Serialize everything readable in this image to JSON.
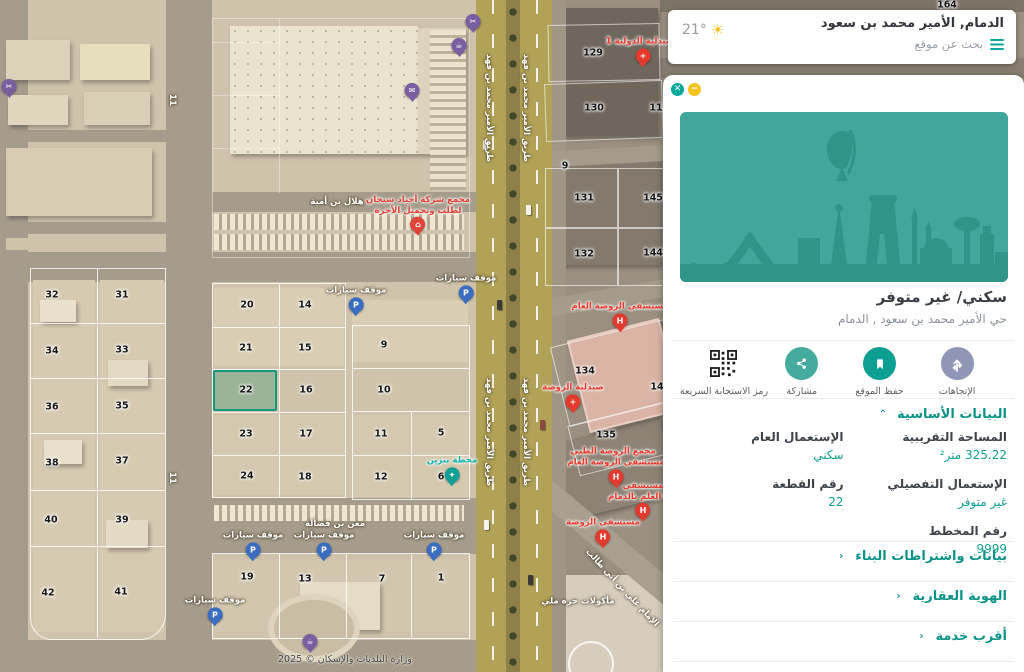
{
  "search_card": {
    "title": "الدمام, الأمير محمد بن سعود",
    "placeholder": "بحث عن موقع",
    "temperature": "21°"
  },
  "panel": {
    "close_glyph": "✕",
    "minimize_glyph": "−",
    "usage_title": "سكني/ غير متوفر",
    "address": "حي الأمير محمد بن سعود , الدمام",
    "actions": [
      {
        "label": "الإتجاهات",
        "icon": "directions-icon",
        "color": "#8f96b6"
      },
      {
        "label": "حفظ الموقع",
        "icon": "bookmark-icon",
        "color": "#0da092"
      },
      {
        "label": "مشاركة",
        "icon": "share-icon",
        "color": "#46ab9f"
      },
      {
        "label": "رمز الاستجابة السريعة",
        "icon": "qr-icon",
        "color": "#1b1b1b"
      }
    ],
    "basic_section_title": "البيانات الأساسية",
    "basic_chevron": "⌃",
    "section_chevron": "‹",
    "fields": [
      {
        "label": "المساحة التقريبية",
        "value": "325.22 متر²"
      },
      {
        "label": "الإستعمال العام",
        "value": "سكني"
      },
      {
        "label": "الإستعمال التفصيلي",
        "value": "غير متوفر"
      },
      {
        "label": "رقم القطعة",
        "value": "22"
      },
      {
        "label": "رقم المخطط",
        "value": "9999"
      }
    ],
    "collapsed_sections": [
      "بيانات واشتراطات البناء",
      "الهوية العقارية",
      "أقرب خدمة"
    ]
  },
  "map": {
    "watermark": "وزارة البلديات والإسكان © 2025",
    "selected_parcel": "22",
    "parcels": [
      {
        "n": "32",
        "x": 52,
        "y": 295
      },
      {
        "n": "31",
        "x": 122,
        "y": 295
      },
      {
        "n": "34",
        "x": 52,
        "y": 351
      },
      {
        "n": "33",
        "x": 122,
        "y": 350
      },
      {
        "n": "36",
        "x": 52,
        "y": 407
      },
      {
        "n": "35",
        "x": 122,
        "y": 406
      },
      {
        "n": "38",
        "x": 52,
        "y": 463
      },
      {
        "n": "37",
        "x": 122,
        "y": 461
      },
      {
        "n": "40",
        "x": 51,
        "y": 520
      },
      {
        "n": "39",
        "x": 122,
        "y": 520
      },
      {
        "n": "42",
        "x": 48,
        "y": 593
      },
      {
        "n": "41",
        "x": 121,
        "y": 592
      },
      {
        "n": "20",
        "x": 247,
        "y": 305
      },
      {
        "n": "14",
        "x": 305,
        "y": 305
      },
      {
        "n": "21",
        "x": 246,
        "y": 348
      },
      {
        "n": "15",
        "x": 305,
        "y": 348
      },
      {
        "n": "22",
        "x": 246,
        "y": 390
      },
      {
        "n": "16",
        "x": 306,
        "y": 390
      },
      {
        "n": "23",
        "x": 246,
        "y": 434
      },
      {
        "n": "17",
        "x": 306,
        "y": 434
      },
      {
        "n": "24",
        "x": 247,
        "y": 476
      },
      {
        "n": "18",
        "x": 305,
        "y": 477
      },
      {
        "n": "9",
        "x": 384,
        "y": 345
      },
      {
        "n": "10",
        "x": 384,
        "y": 390
      },
      {
        "n": "11",
        "x": 381,
        "y": 434
      },
      {
        "n": "5",
        "x": 441,
        "y": 433
      },
      {
        "n": "12",
        "x": 381,
        "y": 477
      },
      {
        "n": "6",
        "x": 441,
        "y": 477
      },
      {
        "n": "19",
        "x": 247,
        "y": 577
      },
      {
        "n": "13",
        "x": 305,
        "y": 579
      },
      {
        "n": "7",
        "x": 382,
        "y": 579
      },
      {
        "n": "1",
        "x": 441,
        "y": 578
      },
      {
        "n": "129",
        "x": 593,
        "y": 53
      },
      {
        "n": "130",
        "x": 594,
        "y": 108
      },
      {
        "n": "11",
        "x": 656,
        "y": 108
      },
      {
        "n": "9",
        "x": 565,
        "y": 166
      },
      {
        "n": "131",
        "x": 584,
        "y": 198
      },
      {
        "n": "145",
        "x": 653,
        "y": 198
      },
      {
        "n": "132",
        "x": 584,
        "y": 254
      },
      {
        "n": "144",
        "x": 653,
        "y": 253
      },
      {
        "n": "134",
        "x": 585,
        "y": 371
      },
      {
        "n": "14",
        "x": 657,
        "y": 387
      },
      {
        "n": "135",
        "x": 606,
        "y": 435
      },
      {
        "n": "164",
        "x": 947,
        "y": 5
      }
    ],
    "pois": [
      {
        "x": 473,
        "y": 37,
        "c": "#7a5fa0",
        "g": "✂"
      },
      {
        "x": 459,
        "y": 61,
        "c": "#7a5fa0",
        "g": "☕"
      },
      {
        "x": 412,
        "y": 106,
        "c": "#7a5fa0",
        "g": "✉"
      },
      {
        "x": 9,
        "y": 102,
        "c": "#7a5fa0",
        "g": "✂"
      },
      {
        "x": 310,
        "y": 657,
        "c": "#7a5fa0",
        "g": "☕"
      },
      {
        "x": 418,
        "y": 240,
        "c": "#de453a",
        "g": "⌂",
        "label": "مجمع شركة أجياد سيجان\nلطلب وتحميل الأجرة",
        "lc": "#e03f33"
      },
      {
        "x": 356,
        "y": 320,
        "c": "#3a6cc0",
        "g": "P",
        "label": "موقف سيارات",
        "lc": "#ffffff"
      },
      {
        "x": 466,
        "y": 308,
        "c": "#3a6cc0",
        "g": "P",
        "label": "موقف سيارات",
        "lc": "#ffffff"
      },
      {
        "x": 253,
        "y": 565,
        "c": "#3a6cc0",
        "g": "P",
        "label": "موقف سيارات",
        "lc": "#ffffff"
      },
      {
        "x": 324,
        "y": 565,
        "c": "#3a6cc0",
        "g": "P",
        "label": "موقف سيارات",
        "lc": "#ffffff"
      },
      {
        "x": 434,
        "y": 565,
        "c": "#3a6cc0",
        "g": "P",
        "label": "موقف سيارات",
        "lc": "#ffffff"
      },
      {
        "x": 215,
        "y": 630,
        "c": "#3a6cc0",
        "g": "P",
        "label": "موقف سيارات",
        "lc": "#ffffff"
      },
      {
        "x": 452,
        "y": 490,
        "c": "#12a096",
        "g": "✦",
        "label": "محطة بنزين",
        "lc": "#12b3a8"
      },
      {
        "x": 620,
        "y": 336,
        "c": "#e23b2e",
        "g": "H",
        "label": "مستشفى الروضة العام",
        "lc": "#e8392b"
      },
      {
        "x": 616,
        "y": 492,
        "c": "#e23b2e",
        "g": "H",
        "label": "مستشفى الروضة العام",
        "lc": "#e8392b"
      },
      {
        "x": 643,
        "y": 526,
        "c": "#e23b2e",
        "g": "H",
        "label": "مستشفى\nرفا العلم بالدمام",
        "lc": "#e8392b"
      },
      {
        "x": 603,
        "y": 552,
        "c": "#e23b2e",
        "g": "H",
        "label": "مستشفى الروضة",
        "lc": "#e8392b"
      },
      {
        "x": 613,
        "y": 458,
        "label": "مجمع الروضة الطبي",
        "lc": "#e8392b"
      },
      {
        "x": 573,
        "y": 417,
        "c": "#e23b2e",
        "g": "+",
        "label": "صيدلية الروضة",
        "lc": "#e8392b"
      },
      {
        "x": 643,
        "y": 71,
        "c": "#e23b2e",
        "g": "+",
        "label": "الصيدلية الدولية 1",
        "lc": "#e8392b"
      },
      {
        "x": 578,
        "y": 608,
        "label": "مأكولات حره ملي",
        "lc": "#ffffff"
      }
    ],
    "street_labels": [
      {
        "t": "هلال بن أمية",
        "x": 337,
        "y": 202,
        "r": 0
      },
      {
        "t": "معن بن فضالة",
        "x": 335,
        "y": 524,
        "r": 0
      },
      {
        "t": "طريق الأمير محمد بن فهد",
        "x": 489,
        "y": 108,
        "r": 90
      },
      {
        "t": "طريق الأمير محمد بن فهد",
        "x": 526,
        "y": 108,
        "r": 90
      },
      {
        "t": "طريق الأمير محمد بن فهد",
        "x": 489,
        "y": 432,
        "r": 90
      },
      {
        "t": "طريق الأمير محمد بن فهد",
        "x": 526,
        "y": 432,
        "r": 90
      },
      {
        "t": "الإمام علي بن أبي طالب",
        "x": 622,
        "y": 588,
        "r": 47
      },
      {
        "t": "11",
        "x": 172,
        "y": 100,
        "r": 90
      },
      {
        "t": "11",
        "x": 172,
        "y": 478,
        "r": 90
      }
    ]
  }
}
